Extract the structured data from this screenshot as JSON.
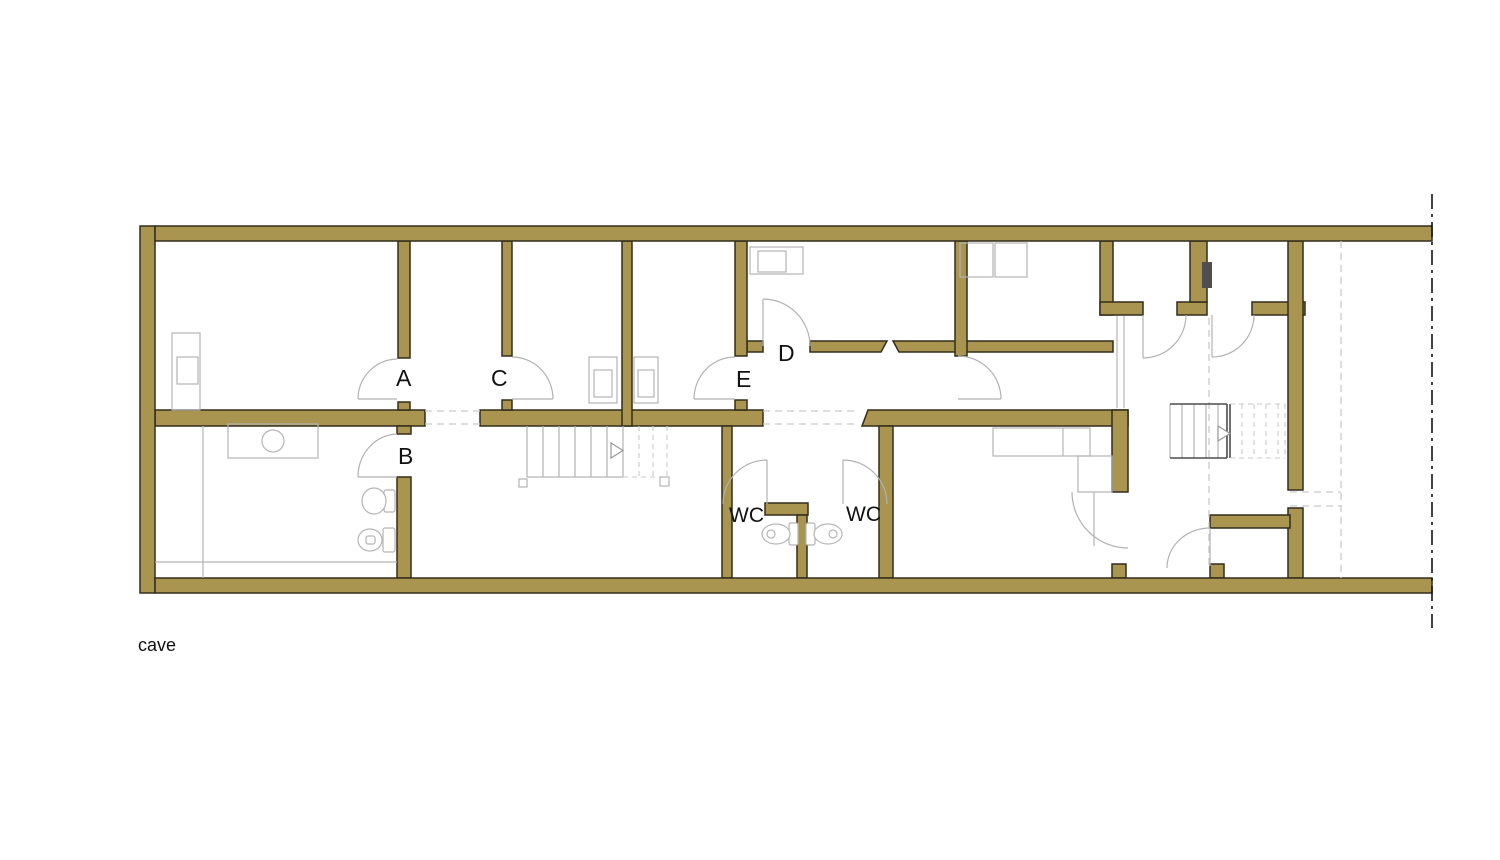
{
  "plan": {
    "floor_label": "cave",
    "door_labels": {
      "a": "A",
      "b": "B",
      "c": "C",
      "d": "D",
      "e": "E"
    },
    "wc_labels": [
      "WC",
      "WC"
    ],
    "colors": {
      "wall_fill": "#a99450",
      "wall_outline": "#332d1a",
      "fixture_line": "#b5b5b5",
      "door_line": "#b2b2b2",
      "dashed_line": "#c9c9c9",
      "stair_dark": "#4d4d4d",
      "duct_fill": "#4f4f4f",
      "boundary_line": "#141414",
      "label_text": "#111111"
    }
  }
}
